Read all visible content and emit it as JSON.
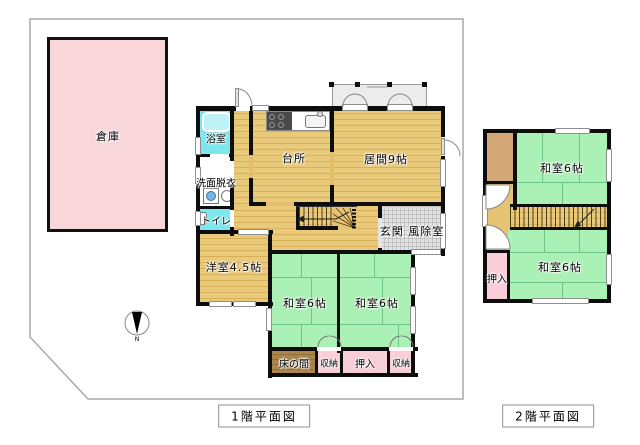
{
  "floor1": {
    "caption": "1階平面図",
    "warehouse": "倉庫",
    "bathroom": "浴室",
    "washroom": "洗面脱衣",
    "toilet": "トイレ",
    "kitchen": "台所",
    "living": "居間9帖",
    "entrance": "玄関 風除室",
    "western_room": "洋室4.5帖",
    "japanese_room_left": "和室6帖",
    "japanese_room_right": "和室6帖",
    "tokonoma": "床の間",
    "storage_left": "収納",
    "closet": "押入",
    "storage_right": "収納",
    "compass_letter": "N"
  },
  "floor2": {
    "caption": "2階平面図",
    "japanese_room_top": "和室6帖",
    "japanese_room_bottom": "和室6帖",
    "closet": "押入"
  },
  "colors": {
    "wood_floor": "#e9c97a",
    "tatami_green": "#abf0b4",
    "water_cyan": "#7de7ef",
    "closet_pink": "#f8cfd7",
    "warehouse_pink": "#f9d6da",
    "tokonoma_brown": "#aa854e",
    "closet2f_brown": "#d4a876",
    "tile_gray": "#e4e4e4",
    "wall_black": "#0d0d0d"
  }
}
